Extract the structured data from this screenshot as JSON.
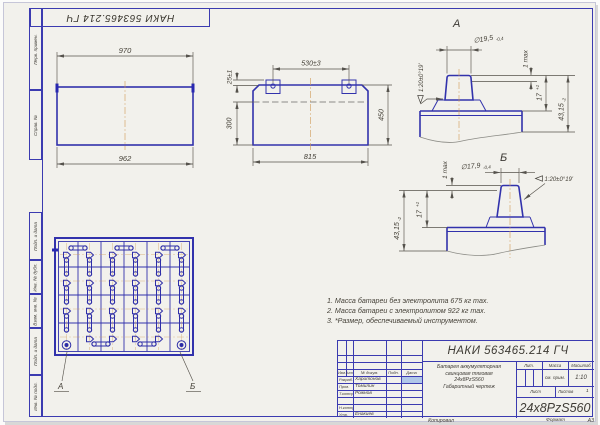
{
  "page": {
    "stamp": "НАКИ 563465.214 ГЧ"
  },
  "margin": {
    "labels": [
      "Перв. примен.",
      "Справ. №",
      "Подп. и дата",
      "Инв. № дубл.",
      "Взам. инв. №",
      "Подп. и дата",
      "Инв. № подл."
    ]
  },
  "views": {
    "side": {
      "top": "970",
      "bottom": "962"
    },
    "front": {
      "lugs": "530±3",
      "lug": "25±1",
      "level": "300",
      "height": "450",
      "width": "815"
    },
    "plan": {
      "a": "А",
      "b": "Б"
    }
  },
  "detail_a": {
    "label": "А",
    "dia": "∅19,5",
    "dia_tol": "-0,4",
    "gap": "1 max",
    "h1": "17",
    "h1_tol": "+1",
    "h2": "43,15",
    "h2_tol": "-2",
    "taper": "1:20±0°19'"
  },
  "detail_b": {
    "label": "Б",
    "dia": "∅17,9",
    "dia_tol": "-0,4",
    "gap": "1 max",
    "h1": "17",
    "h1_tol": "+1",
    "h2": "43,15",
    "h2_tol": "-2",
    "taper": "1:20±0°19'"
  },
  "notes": {
    "n1": "1. Масса батареи без электролита 675 кг max.",
    "n2": "2. Масса батареи с электролитом 922 кг max.",
    "n3": "3. *Размер, обеспечиваемый инструментом."
  },
  "title_block": {
    "designation": "НАКИ 563465.214 ГЧ",
    "desc1": "Батарея аккумуляторная",
    "desc2": "свинцовая тяговая",
    "desc3": "24х8PzS560",
    "desc4": "Габаритный чертеж",
    "code": "24х8PzS560",
    "cols": {
      "izm": "Изм.",
      "list": "Лист",
      "doc": "№ докум.",
      "sign": "Подп.",
      "date": "Дата"
    },
    "rows": [
      {
        "role": "Разраб.",
        "name": "Харитонов"
      },
      {
        "role": "Пров.",
        "name": "Томилин"
      },
      {
        "role": "Т.контр.",
        "name": "Рожнов"
      },
      {
        "role": "",
        "name": ""
      },
      {
        "role": "Н.контр.",
        "name": ""
      },
      {
        "role": "Утв.",
        "name": "Енакиев"
      }
    ],
    "lit": "Лит.",
    "mass": "Масса",
    "scale": "Масштаб",
    "mass_v": "см. прим.",
    "scale_v": "1:10",
    "sheet": "Лист",
    "sheets": "Листов",
    "sheets_v": "1",
    "copied": "Копировал",
    "format": "Формат",
    "format_v": "A3"
  }
}
